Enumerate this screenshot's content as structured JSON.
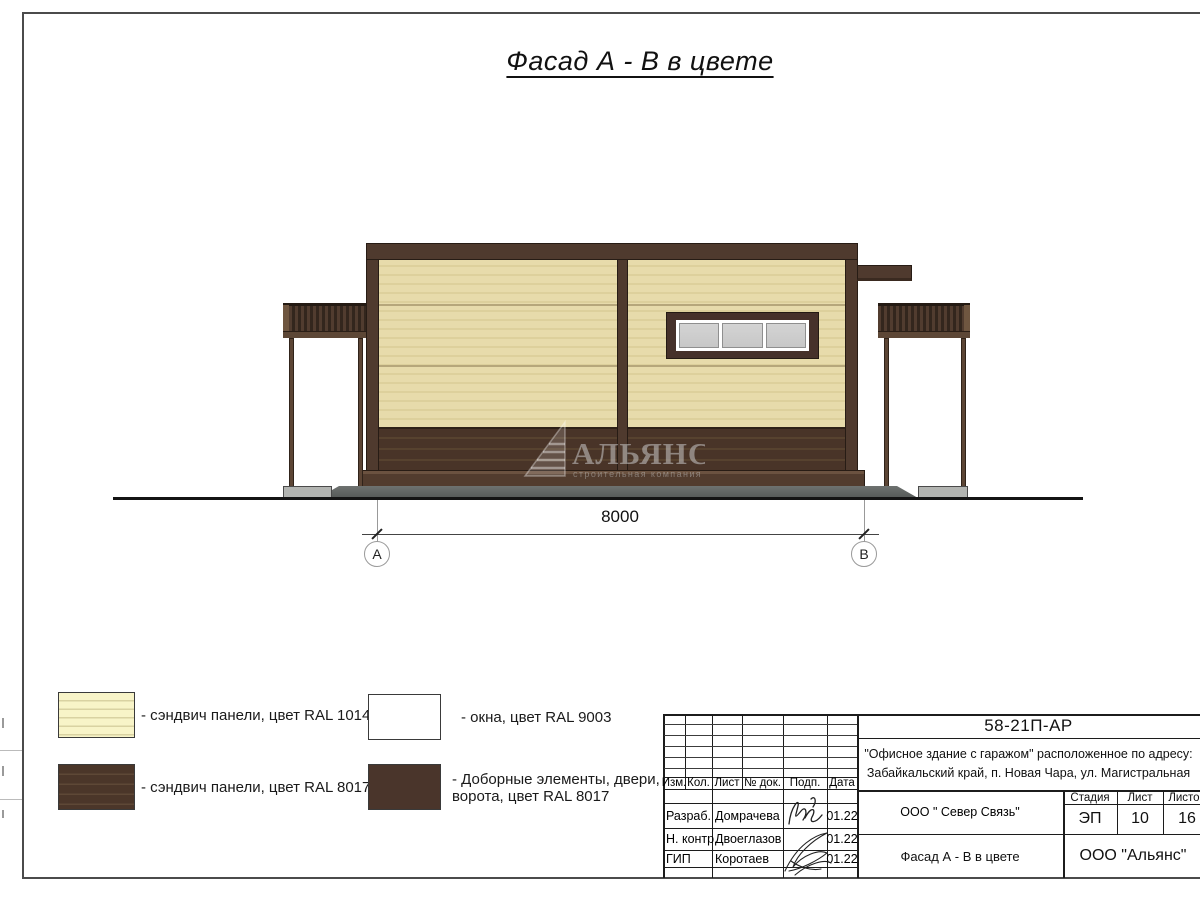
{
  "sheet": {
    "title": "Фасад А - В в цвете"
  },
  "drawing": {
    "dimension": {
      "value": "8000",
      "axis_left": "А",
      "axis_right": "В"
    },
    "watermark": {
      "title": "АЛЬЯНС",
      "subtitle": "строительная компания"
    }
  },
  "legend": [
    {
      "swatch": "ral-1014-lined",
      "label": "- сэндвич панели, цвет RAL 1014"
    },
    {
      "swatch": "ral-8017-lined",
      "label": "- сэндвич панели, цвет RAL 8017"
    },
    {
      "swatch": "ral-9003-plain",
      "label": "- окна, цвет RAL 9003"
    },
    {
      "swatch": "ral-8017-solid",
      "label_line1": "- Доборные элементы, двери,",
      "label_line2": "ворота, цвет RAL 8017"
    }
  ],
  "titleblock": {
    "doc_number": "58-21П-АР",
    "project_line1": "\"Офисное здание с гаражом\" расположенное по адресу:",
    "project_line2": "Забайкальский край, п. Новая Чара, ул. Магистральная",
    "header_cols": [
      "Изм.",
      "Кол.",
      "Лист",
      "№ док.",
      "Подп.",
      "Дата"
    ],
    "rows": [
      {
        "role": "Разраб.",
        "name": "Домрачева",
        "date": "01.22"
      },
      {
        "role": "Н. контр.",
        "name": "Двоеглазов",
        "date": "01.22"
      },
      {
        "role": "ГИП",
        "name": "Коротаев",
        "date": "01.22"
      }
    ],
    "contractor": "ООО \" Север Связь\"",
    "sheet_title": "Фасад А - В в цвете",
    "company": "ООО \"Альянс\"",
    "stage_label": "Стадия",
    "stage_value": "ЭП",
    "sheet_label": "Лист",
    "sheet_value": "10",
    "sheets_label": "Листов",
    "sheets_value": "16"
  },
  "colors": {
    "panel_ral1014": "#e7dbab",
    "panel_ral8017": "#4a3529",
    "window_ral9003": "#ffffff",
    "glass": "#cccccc",
    "structure_brown": "#4f3a2e"
  }
}
